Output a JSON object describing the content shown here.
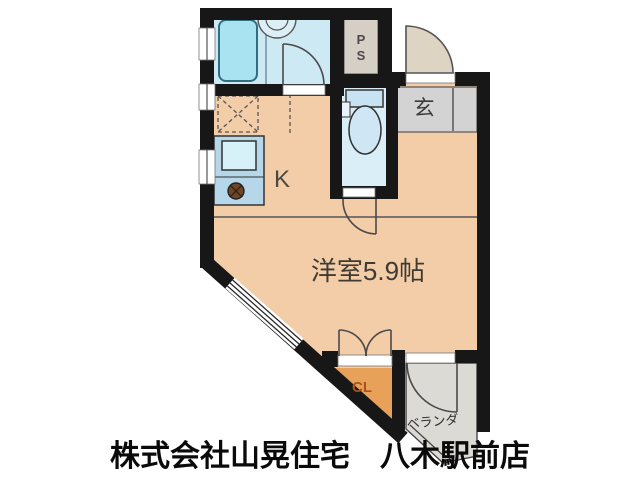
{
  "footer": {
    "company_line": "株式会社山晃住宅　八木駅前店"
  },
  "rooms": {
    "kitchen": {
      "label": "K"
    },
    "main_room": {
      "label": "洋室5.9帖"
    },
    "entrance": {
      "label": "玄"
    },
    "pipe_space": {
      "label": "PS",
      "line1": "P",
      "line2": "S"
    },
    "closet": {
      "label": "CL"
    },
    "balcony": {
      "label": "ベランダ"
    }
  },
  "colors": {
    "wall": "#171717",
    "room_floor": "#f2cda8",
    "wet_floor": "#cde9f3",
    "toilet_floor": "#d9eef6",
    "ps_floor": "#d6cfc5",
    "entrance_floor": "#d3d3d3",
    "closet_floor": "#e8a159",
    "balcony_floor": "#dcdad4",
    "kitchen_unit": "#b5d7e9",
    "bathtub": "#a9e2f0",
    "door_fill": "#ded4c4",
    "closet_text": "#a8541c",
    "label_text": "#3f3a33",
    "footer_text": "#0a0a0a"
  }
}
